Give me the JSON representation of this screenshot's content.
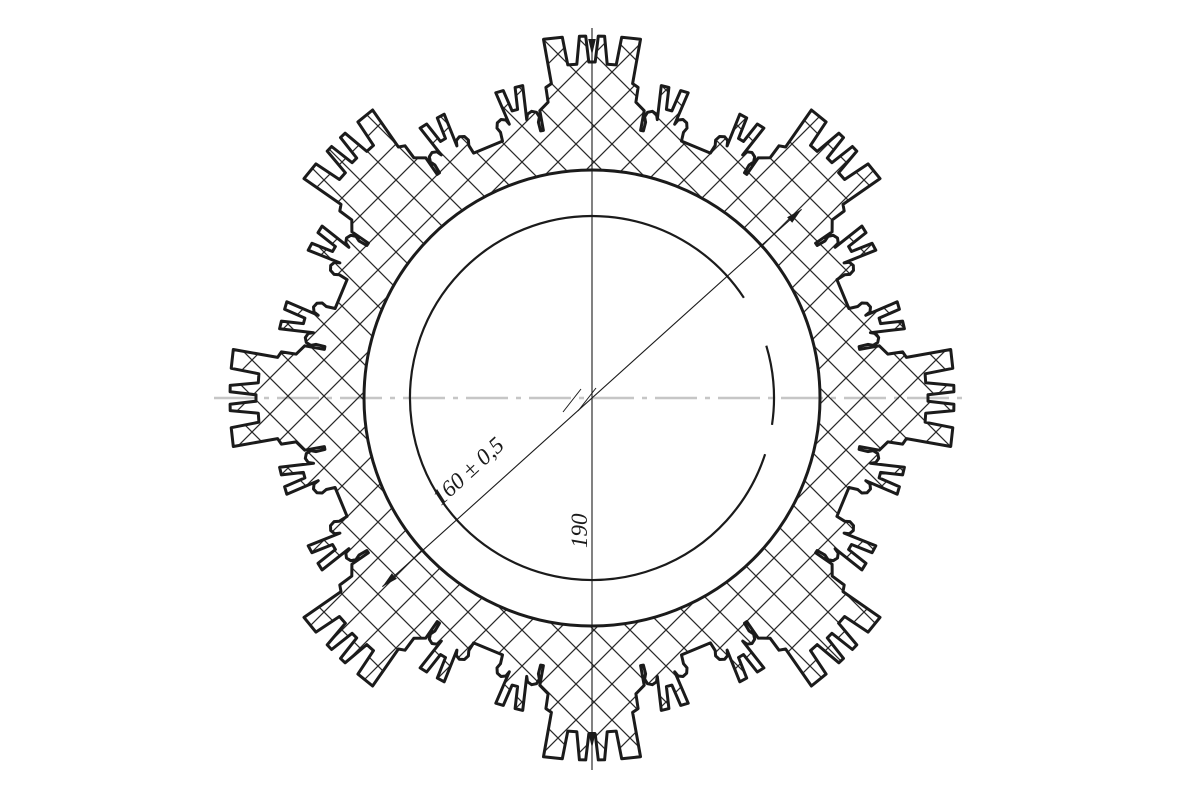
{
  "drawing": {
    "background_color": "#ffffff",
    "line_color": "#1b1b1b",
    "hatch_color": "#2a2a2a",
    "centerline_color": "#c6c6c6",
    "canvas": {
      "width": 1200,
      "height": 800
    },
    "part": {
      "center": {
        "x": 592,
        "y": 398
      },
      "major_tooth_count": 8,
      "radii": {
        "tooth_tip": 362,
        "castellation_slot_root": 334,
        "center_slot_root": 336,
        "minor_tooth_tip": 320,
        "minor_slot_root": 298,
        "gap_root": 272,
        "bore": 228,
        "inner_reference_circle": 182
      },
      "hatch": {
        "spacing": 36,
        "stroke_width": 1.25
      },
      "outline_stroke_width": 3,
      "inner_circle_stroke_width": 2.2,
      "sector_profile_deg_r": [
        [
          -10.9,
          272
        ],
        [
          -10.3,
          272
        ],
        [
          -10.3,
          292
        ],
        [
          -8.45,
          299
        ],
        [
          -8.45,
          314
        ],
        [
          -7.35,
          317
        ],
        [
          -7.7,
          362
        ],
        [
          -4.7,
          362
        ],
        [
          -4.15,
          334
        ],
        [
          -2.6,
          334
        ],
        [
          -2.0,
          362
        ],
        [
          -1.0,
          362
        ],
        [
          -0.55,
          336
        ],
        [
          0.55,
          336
        ],
        [
          1.0,
          362
        ],
        [
          2.0,
          362
        ],
        [
          2.6,
          334
        ],
        [
          4.15,
          334
        ],
        [
          4.7,
          362
        ],
        [
          7.7,
          362
        ],
        [
          7.35,
          317
        ],
        [
          8.45,
          314
        ],
        [
          8.45,
          299
        ],
        [
          10.3,
          292
        ],
        [
          10.3,
          272
        ],
        [
          10.9,
          272
        ],
        [
          11.0,
          281
        ],
        [
          10.6,
          286
        ],
        [
          11.0,
          291
        ],
        [
          11.9,
          293
        ],
        [
          12.8,
          291
        ],
        [
          13.2,
          286
        ],
        [
          12.5,
          320
        ],
        [
          13.9,
          320
        ],
        [
          14.45,
          298
        ],
        [
          15.55,
          298
        ],
        [
          16.1,
          320
        ],
        [
          17.5,
          320
        ],
        [
          16.8,
          286
        ],
        [
          17.2,
          291
        ],
        [
          18.1,
          293
        ],
        [
          19.0,
          291
        ],
        [
          19.4,
          286
        ],
        [
          19.0,
          281
        ],
        [
          19.2,
          272
        ],
        [
          25.8,
          272
        ],
        [
          26.0,
          281
        ],
        [
          25.6,
          286
        ],
        [
          26.0,
          291
        ],
        [
          26.9,
          293
        ],
        [
          27.8,
          291
        ],
        [
          28.2,
          286
        ],
        [
          27.5,
          320
        ],
        [
          28.9,
          320
        ],
        [
          29.45,
          298
        ],
        [
          30.55,
          298
        ],
        [
          31.1,
          320
        ],
        [
          32.5,
          320
        ],
        [
          31.8,
          286
        ],
        [
          32.2,
          291
        ],
        [
          33.1,
          293
        ],
        [
          34.0,
          291
        ],
        [
          34.4,
          286
        ],
        [
          34.0,
          281
        ],
        [
          34.1,
          272
        ]
      ],
      "inner_circle_arcs_ccw_deg": [
        {
          "from": 33.4,
          "to": 342.0
        },
        {
          "from": -8.5,
          "to": 16.7
        }
      ]
    },
    "centerline": {
      "x1": 214,
      "x2": 968,
      "y": 398,
      "dash": "42 8 5 8",
      "stroke_width": 2.4
    },
    "dimensions": [
      {
        "label": "160 ± 0,5",
        "kind": "diagonal-diameter",
        "angle_deg": 42,
        "end_radius": 282,
        "text_pos": {
          "x": 441,
          "y": 506
        },
        "text_rotation_deg": -42.5
      },
      {
        "label": "190",
        "kind": "vertical-diameter",
        "line": {
          "x": 592,
          "y1": 28,
          "y2": 770
        },
        "arrow_tips_y": [
          55,
          748
        ],
        "text_pos": {
          "x": 587,
          "y": 548
        },
        "text_rotation_deg": -90
      }
    ],
    "center_ticks": [
      [
        563,
        412,
        581,
        389
      ],
      [
        578,
        411,
        596,
        388
      ]
    ],
    "arrow": {
      "length": 16,
      "half_width": 3.8,
      "dim_stroke_width": 1.1
    }
  }
}
